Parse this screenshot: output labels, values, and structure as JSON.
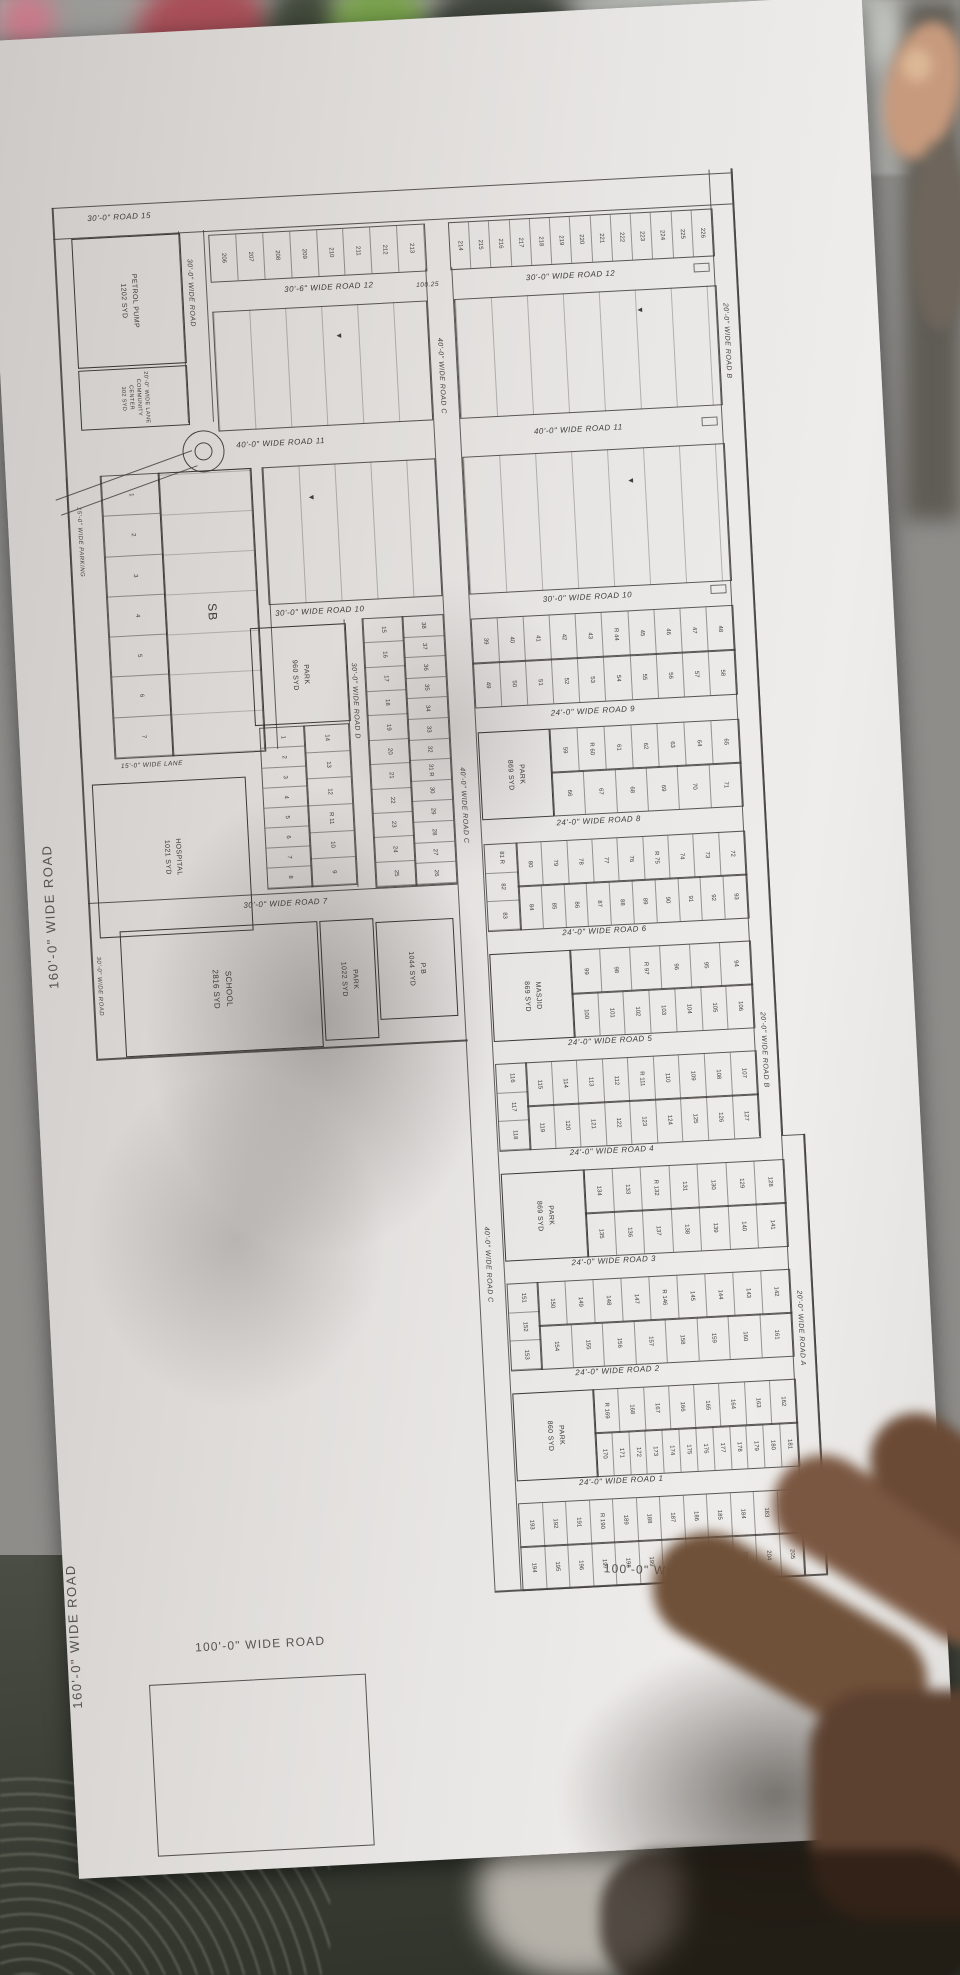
{
  "outside": {
    "left_road": "160'-0\" WIDE ROAD",
    "bottom_left_road": "160'-0\" WIDE ROAD",
    "bottom_road": "100'-0\" WIDE ROAD",
    "bottom_right_road": "100'-0\" WIDE ROAD"
  },
  "markers": {
    "arrow": "▲"
  },
  "plan": {
    "roads": {
      "r15": "30'-0\" ROAD 15",
      "r12_left": "30'-6\" WIDE ROAD 12",
      "r12_dim": "100.25",
      "r12_right": "30'-0\" WIDE ROAD 12",
      "r11_left": "40'-0\" WIDE ROAD 11",
      "r11_right": "40'-0\" WIDE ROAD 11",
      "r10_left": "30'-0\" WIDE ROAD 10",
      "r10_right": "30'-0\" WIDE ROAD 10",
      "r9": "24'-0\" WIDE ROAD 9",
      "r8": "24'-0\" WIDE ROAD 8",
      "r7": "30'-0\" WIDE ROAD 7",
      "r6": "24'-0\" WIDE ROAD 6",
      "r5": "24'-0\" WIDE ROAD 5",
      "r4": "24'-0\" WIDE ROAD 4",
      "r3": "24'-0\" WIDE ROAD 3",
      "r2": "24'-0\" WIDE ROAD 2",
      "r1": "24'-0\" WIDE ROAD 1",
      "road_a": "20'-0\" WIDE ROAD A",
      "road_b": "20'-0\" WIDE ROAD B",
      "road_c": "40'-0\" WIDE ROAD C",
      "road_d": "30'-0\" WIDE ROAD D",
      "road_e": "30'-0\" WIDE ROAD",
      "parking": "15'-0\" WIDE PARKING",
      "lane15": "15'-0\" WIDE LANE",
      "lane20": "20'-0\" WIDE LANE"
    },
    "facilities": {
      "petrol": "PETROL PUMP\n1202 SYD",
      "community": "20'-0\" WIDE LANE\nCOMMUNITY\nCENTER\n302 SYD",
      "hospital": "HOSPITAL\n1021 SYD",
      "school": "SCHOOL\n2816 SYD",
      "park1022": "PARK\n1022 SYD",
      "pb": "P.B\n1044 SYD",
      "park960": "PARK\n960 SYD",
      "masjid": "MASJID\n869 SYD",
      "park869a": "PARK\n869 SYD",
      "park869b": "PARK\n869 SYD",
      "park860": "PARK\n860 SYD",
      "sb": "SB"
    },
    "plots": {
      "parking_col": [
        "1",
        "2",
        "3",
        "4",
        "5",
        "6",
        "7"
      ],
      "col_18": [
        "1",
        "2",
        "3",
        "4",
        "5",
        "6",
        "7",
        "8"
      ],
      "col_914": [
        "14",
        "13",
        "12",
        "R 11",
        "10",
        "9"
      ],
      "g1_left": [
        "15",
        "16",
        "17",
        "18",
        "19",
        "20",
        "21",
        "22",
        "23",
        "24",
        "25"
      ],
      "g1_right": [
        "38",
        "37",
        "36",
        "35",
        "34",
        "33",
        "32",
        "31 R",
        "30",
        "29",
        "28",
        "27",
        "26"
      ],
      "top_left": [
        "206",
        "207",
        "208",
        "209",
        "210",
        "211",
        "212",
        "213"
      ],
      "top_right": [
        "214",
        "215",
        "216",
        "217",
        "218",
        "219",
        "220",
        "221",
        "222",
        "223",
        "224",
        "225",
        "226"
      ],
      "b109_r1": [
        "39",
        "40",
        "41",
        "42",
        "43",
        "R 44",
        "45",
        "46",
        "47",
        "48"
      ],
      "b109_r2": [
        "49",
        "50",
        "51",
        "52",
        "53",
        "54",
        "55",
        "56",
        "57",
        "58"
      ],
      "b98_r1": [
        "59",
        "R 60",
        "61",
        "62",
        "63",
        "64",
        "65"
      ],
      "b98_r2": [
        "66",
        "67",
        "68",
        "69",
        "70",
        "71"
      ],
      "b86_stack": [
        "81 R",
        "82",
        "83"
      ],
      "b86_r1": [
        "80",
        "79",
        "78",
        "77",
        "76",
        "R 75",
        "74",
        "73",
        "72"
      ],
      "b86_r2": [
        "84",
        "85",
        "86",
        "87",
        "88",
        "89",
        "90",
        "91",
        "92",
        "93"
      ],
      "b65_r1": [
        "99",
        "98",
        "R 97",
        "96",
        "95",
        "94"
      ],
      "b65_r2": [
        "100",
        "101",
        "102",
        "103",
        "104",
        "105",
        "106"
      ],
      "b54_stack": [
        "116",
        "117",
        "118"
      ],
      "b54_r1": [
        "115",
        "114",
        "113",
        "112",
        "R 111",
        "110",
        "109",
        "108",
        "107"
      ],
      "b54_r2": [
        "119",
        "120",
        "121",
        "122",
        "123",
        "124",
        "125",
        "126",
        "127"
      ],
      "b43_r1": [
        "134",
        "133",
        "R 132",
        "131",
        "130",
        "129",
        "128"
      ],
      "b43_r2": [
        "135",
        "136",
        "137",
        "138",
        "139",
        "140",
        "141"
      ],
      "b32_stack": [
        "151",
        "152",
        "153"
      ],
      "b32_r1": [
        "150",
        "149",
        "148",
        "147",
        "R 146",
        "145",
        "144",
        "143",
        "142"
      ],
      "b32_r2": [
        "154",
        "155",
        "156",
        "157",
        "158",
        "159",
        "160",
        "161"
      ],
      "b21_r1": [
        "R 169",
        "168",
        "167",
        "166",
        "165",
        "164",
        "163",
        "162"
      ],
      "b21_r2": [
        "170",
        "171",
        "172",
        "173",
        "174",
        "175",
        "176",
        "177",
        "178",
        "179",
        "180",
        "181"
      ],
      "b10_r1": [
        "193",
        "192",
        "191",
        "R 190",
        "189",
        "188",
        "187",
        "186",
        "185",
        "184",
        "183",
        "182"
      ],
      "b10_r2": [
        "194",
        "195",
        "196",
        "197",
        "198",
        "199",
        "200",
        "201",
        "202",
        "203",
        "204",
        "205"
      ]
    }
  }
}
